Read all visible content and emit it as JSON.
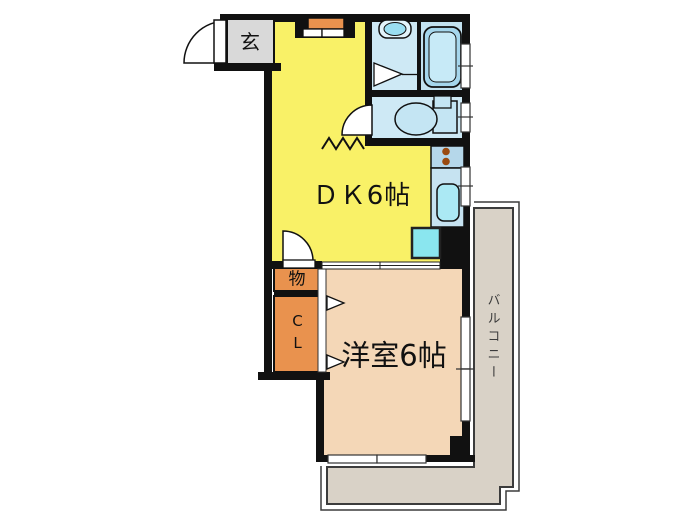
{
  "plan": {
    "type": "japanese-apartment-floor-plan",
    "labels": {
      "entrance": "玄",
      "dining_kitchen": "ＤＫ6帖",
      "western_room": "洋室6帖",
      "storage": "物",
      "closet": "CL",
      "balcony": "バルコニー"
    }
  },
  "colors": {
    "wall": "#111111",
    "dk_floor": "#F9F167",
    "room_floor": "#F4D7B7",
    "closet_fill": "#E9924E",
    "cabinet_fill": "#E9924E",
    "entrance_floor": "#D9D9D9",
    "washroom_floor": "#CEE9F5",
    "bath_floor": "#C3E2F0",
    "toilet_floor": "#CEE9F5",
    "counter_fill": "#C6E3F1",
    "stove_fill": "#B5D7EA",
    "burner_color": "#9A4A10",
    "sink_fill": "#ABE9F4",
    "tub_fill": "#A5D6EC",
    "tub_inner": "#C7EAF7",
    "basin_fill": "#E2F4FB",
    "basin_bowl": "#9ADFF2",
    "toilet_fill": "#C4E5F3",
    "fridge_fill": "#8AE6EF",
    "balcony_floor": "#D9D2C7",
    "balcony_line": "#3C3C3C"
  }
}
